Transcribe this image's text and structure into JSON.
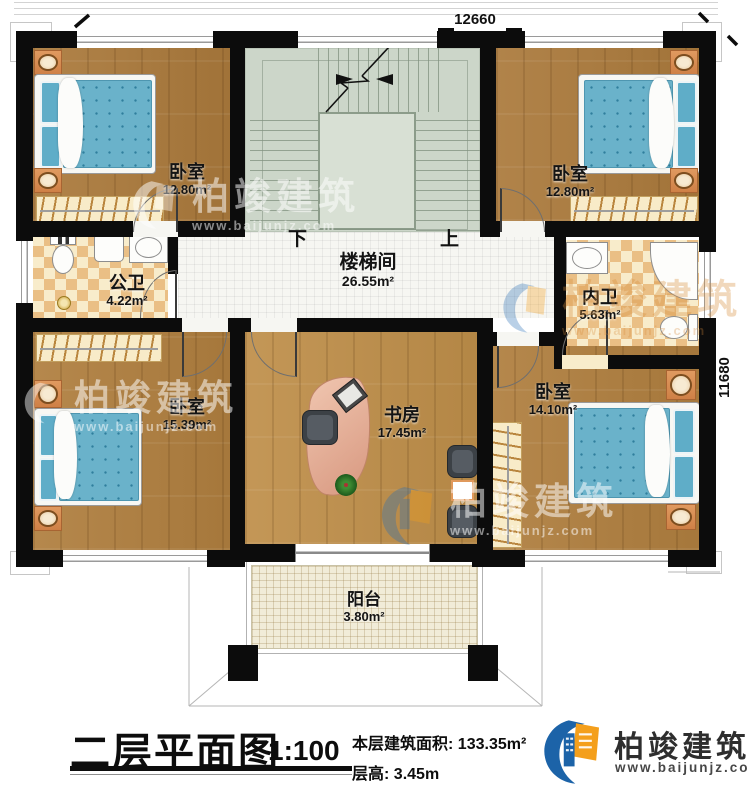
{
  "dimensions": {
    "top": "12660",
    "right": "11680"
  },
  "stair": {
    "down": "下",
    "up": "上"
  },
  "rooms": {
    "stair_hall": {
      "label": "楼梯间",
      "area": "26.55m²"
    },
    "bedroom_tl": {
      "label": "卧室",
      "area": "12.80m²"
    },
    "bedroom_tr": {
      "label": "卧室",
      "area": "12.80m²"
    },
    "bath_public": {
      "label": "公卫",
      "area": "4.22m²"
    },
    "bath_inner": {
      "label": "内卫",
      "area": "5.63m²"
    },
    "bedroom_bl": {
      "label": "卧室",
      "area": "15.39m²"
    },
    "study": {
      "label": "书房",
      "area": "17.45m²"
    },
    "bedroom_br": {
      "label": "卧室",
      "area": "14.10m²"
    },
    "balcony": {
      "label": "阳台",
      "area": "3.80m²"
    }
  },
  "title_block": {
    "plan_title": "二层平面图",
    "scale": "1:100",
    "area_label": "本层建筑面积:",
    "area_value": "133.35m²",
    "floor_height_label": "层高:",
    "floor_height_value": "3.45m"
  },
  "brand": {
    "name": "柏竣建筑",
    "website": "www.baijunjz.com",
    "blue": "#1c63a8",
    "orange": "#f49f1b"
  },
  "watermark": {
    "name": "柏竣建筑",
    "website": "www.baijunjz.com"
  }
}
